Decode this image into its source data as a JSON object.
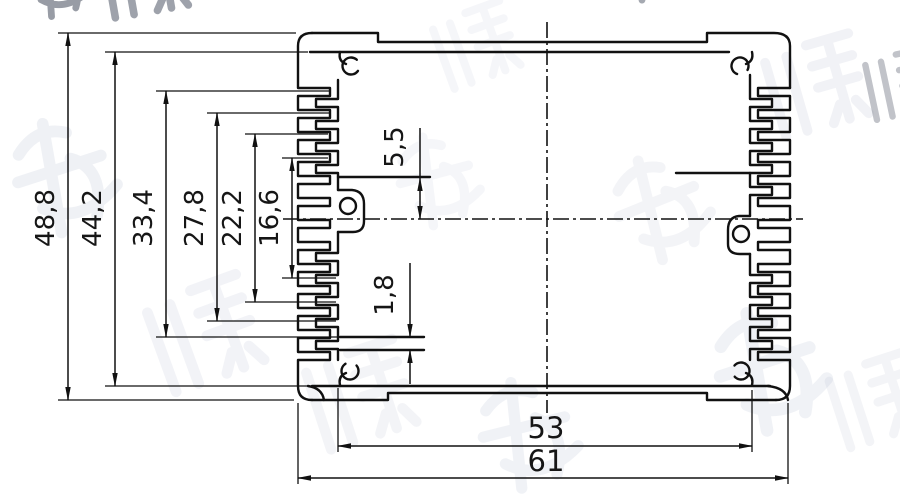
{
  "drawing": {
    "type": "aluminum-extrusion-profile-cross-section",
    "units_style": "comma-decimal",
    "dims": {
      "vertical": [
        "48,8",
        "44,2",
        "33,4",
        "27,8",
        "22,2",
        "16,6"
      ],
      "detail_top": "5,5",
      "detail_slot": "1,8",
      "inner_width": "53",
      "outer_width": "61"
    },
    "colors": {
      "line": "#111111",
      "background": "#ffffff",
      "watermark": "#9aa5c0"
    },
    "watermark": {
      "text": "鸿发顺达"
    }
  }
}
